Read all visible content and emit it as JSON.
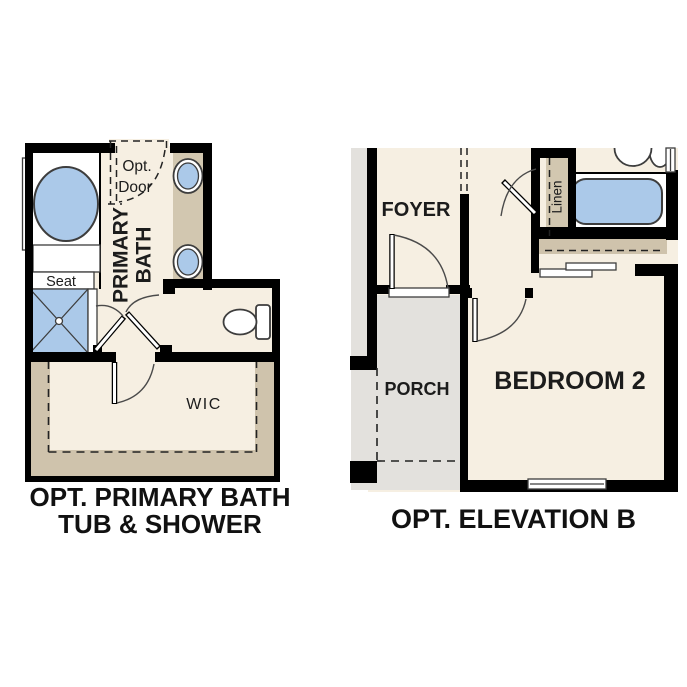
{
  "colors": {
    "wall": "#000000",
    "floor": "#f6efe2",
    "tan": "#cfc3ac",
    "ctan": "#d2c7b0",
    "blue": "#abc9e9",
    "gray": "#e3e1dd",
    "line": "#3d3d3d",
    "tx": "#1c1c1c"
  },
  "left_plan": {
    "caption_line1": "OPT. PRIMARY BATH",
    "caption_line2": "TUB & SHOWER",
    "labels": {
      "opt_door_1": "Opt.",
      "opt_door_2": "Door",
      "primary_1": "PRIMARY",
      "primary_2": "BATH",
      "seat": "Seat",
      "wic": "WIC"
    }
  },
  "right_plan": {
    "caption": "OPT. ELEVATION B",
    "labels": {
      "foyer": "FOYER",
      "porch": "PORCH",
      "bedroom": "BEDROOM 2",
      "linen": "Linen"
    }
  }
}
